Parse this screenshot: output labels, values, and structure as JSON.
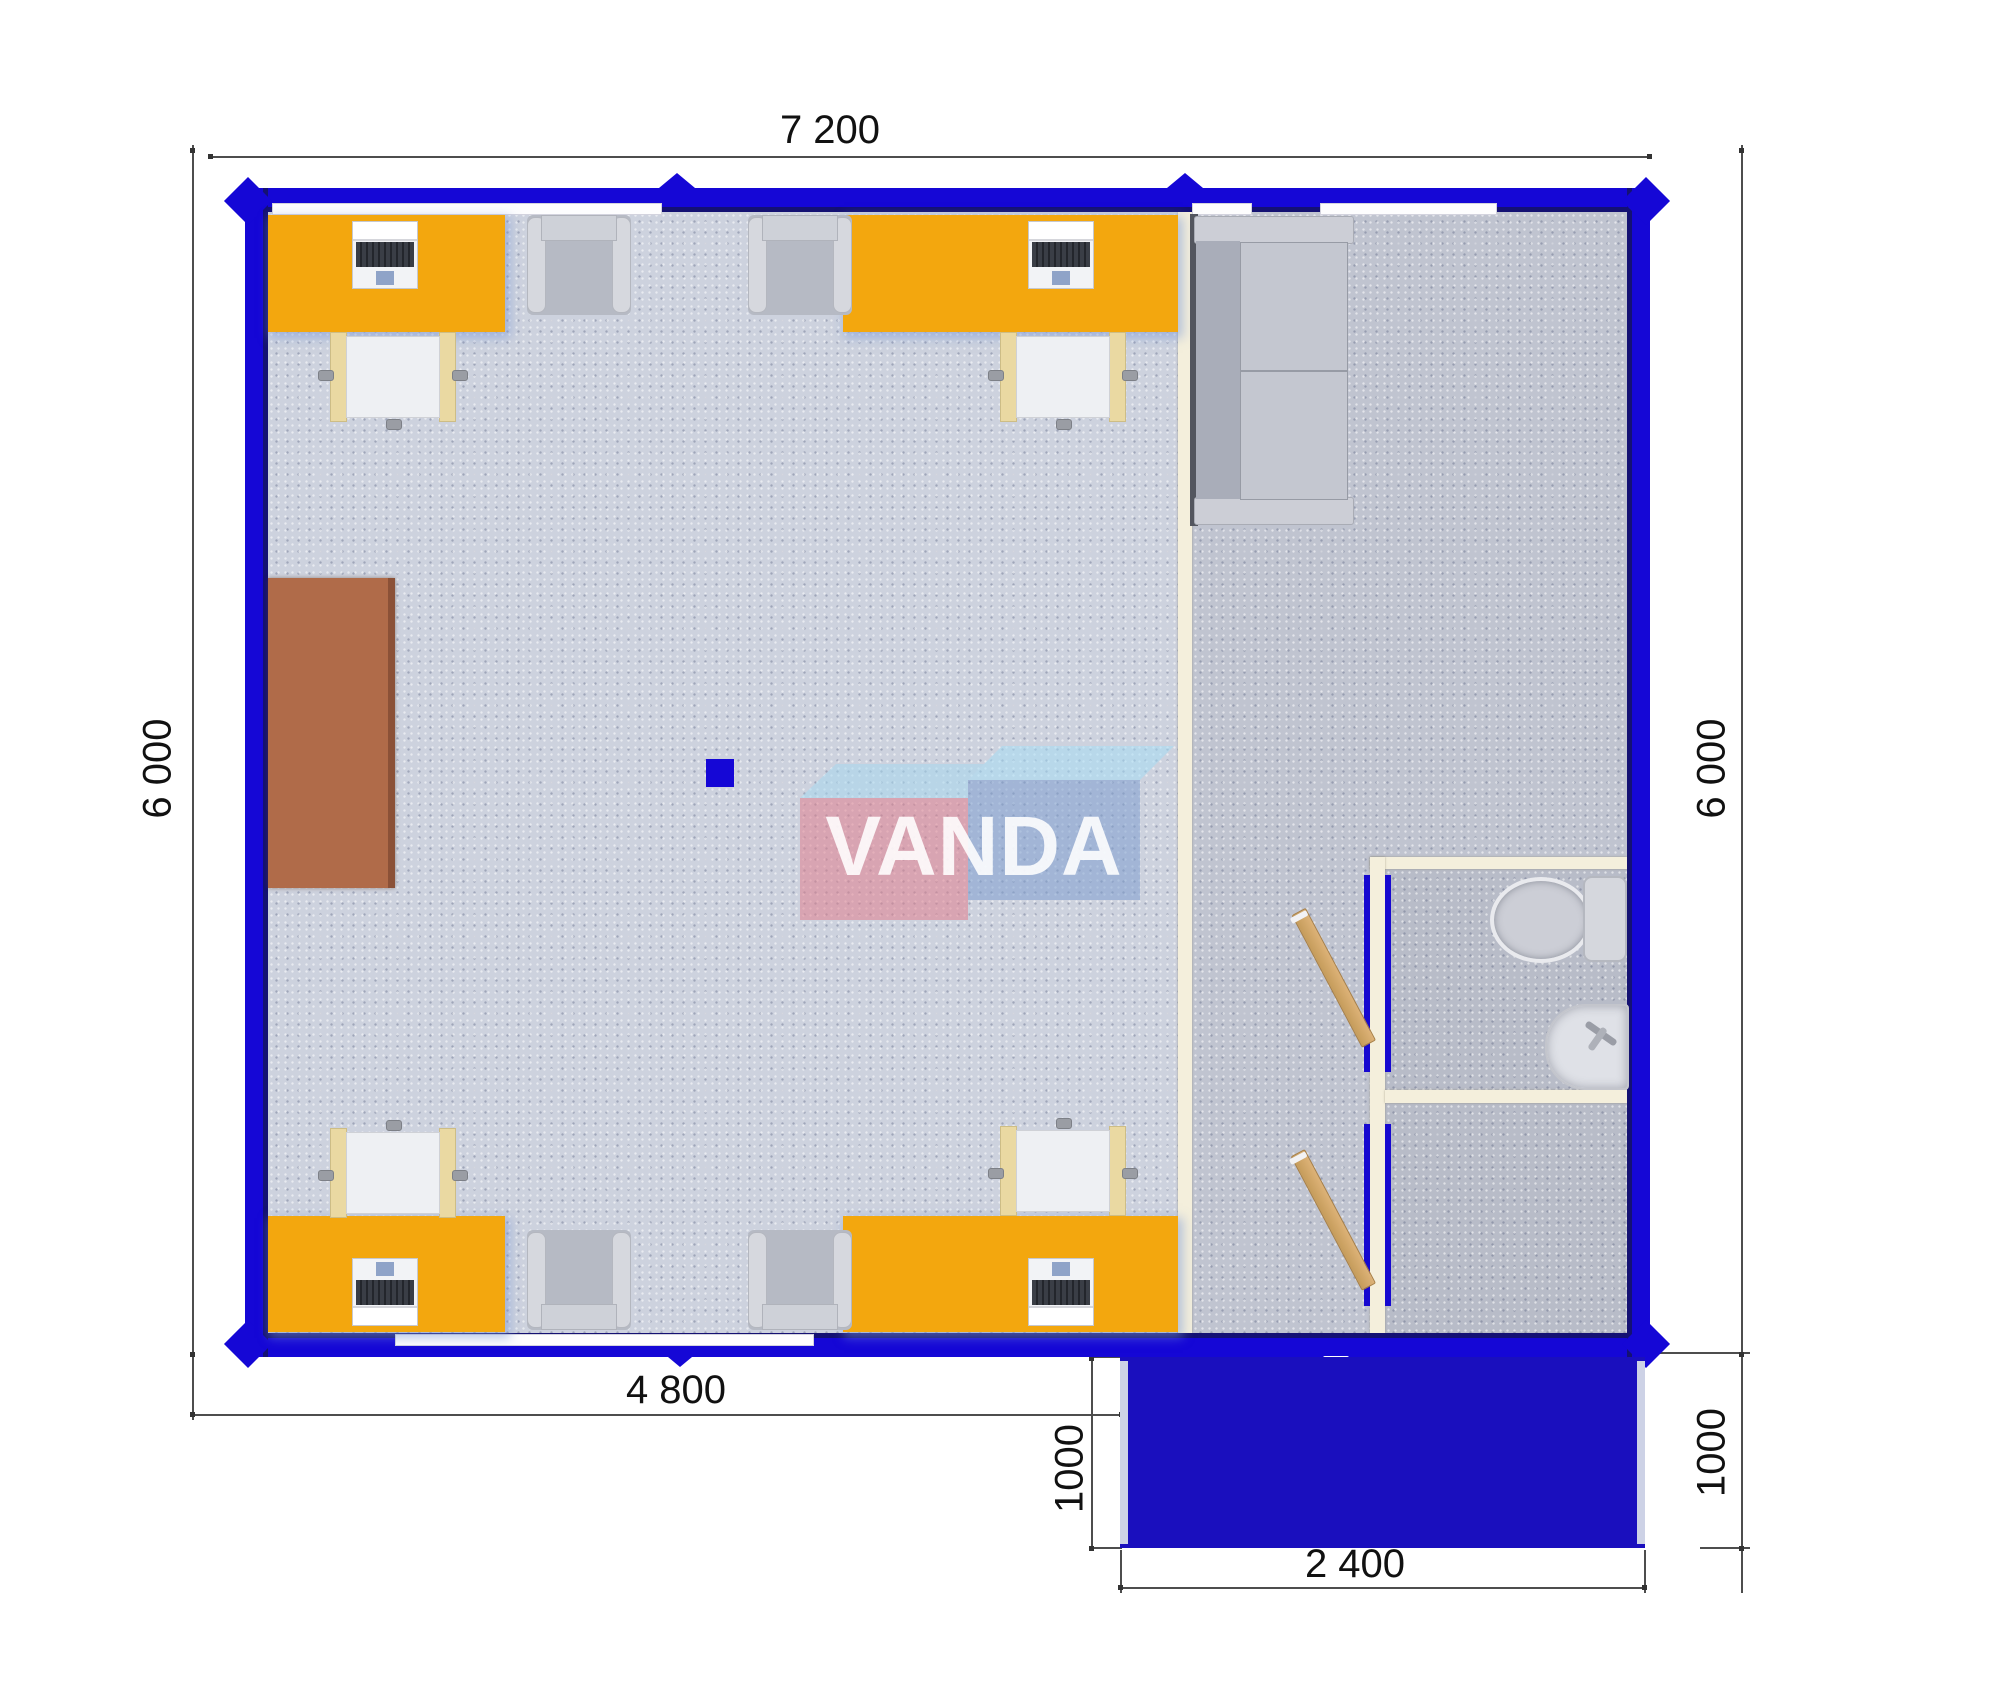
{
  "annotations": {
    "width_total": "7 200",
    "height_left": "6 000",
    "height_right": "6 000",
    "width_main_bottom": "4 800",
    "porch_depth_left": "1000",
    "porch_depth_right": "1000",
    "porch_width": "2 400"
  },
  "watermark": {
    "text": "VANDA"
  },
  "colors": {
    "wall_blue": "#1507D6",
    "wall_inner_navy": "#141173",
    "porch_blue": "#1A0FBE",
    "desk_orange": "#F3A70E",
    "cabinet_brown": "#B06B49",
    "partition_cream": "#F4EFDC",
    "floor_main": "#CDD2DE",
    "floor_hall": "#C0C4D0",
    "floor_wet": "#B8BCC8",
    "door_wood": "#D4A467",
    "watermark_pink": "#E2808F",
    "watermark_blue": "#7F9FD0",
    "dimension_text": "#111111"
  }
}
